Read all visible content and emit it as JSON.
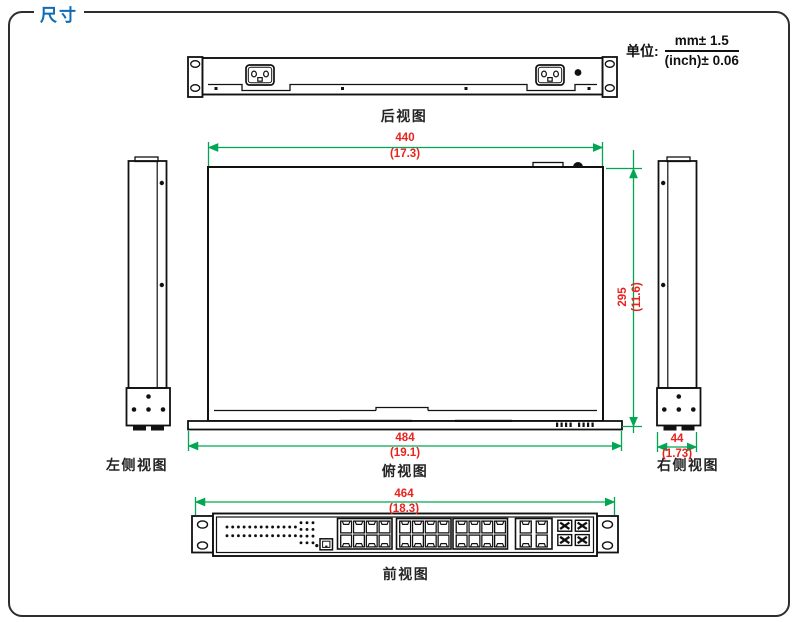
{
  "title": "尺寸",
  "unit": {
    "label": "单位:",
    "mm_tolerance": "mm± 1.5",
    "inch_tolerance": "(inch)± 0.06"
  },
  "views": {
    "rear": "后视图",
    "left_side": "左侧视图",
    "top": "俯视图",
    "right_side": "右侧视图",
    "front": "前视图"
  },
  "dimensions": {
    "top_width": {
      "mm": "440",
      "inch": "(17.3)"
    },
    "top_depth": {
      "mm": "295",
      "inch": "(11.6)"
    },
    "overall_width": {
      "mm": "484",
      "inch": "(19.1)"
    },
    "side_width": {
      "mm": "44",
      "inch": "(1.73)"
    },
    "front_width": {
      "mm": "464",
      "inch": "(18.3)"
    }
  },
  "colors": {
    "dimension_line": "#00A651",
    "dimension_text": "#E8221F",
    "title_blue": "#0D6CB5",
    "line_black": "#1a1a1a"
  }
}
